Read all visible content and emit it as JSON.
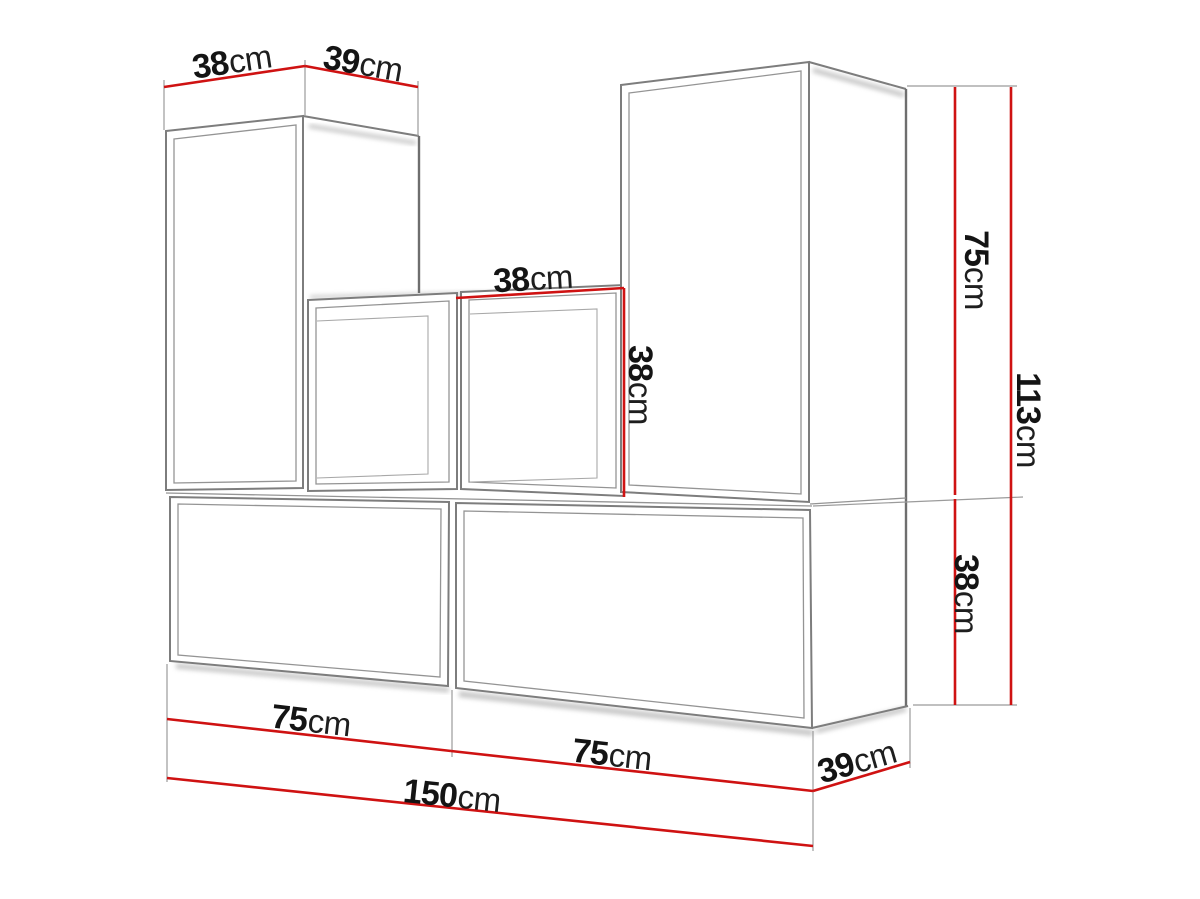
{
  "diagram": {
    "type": "furniture-dimension-diagram",
    "subject": "modular wall unit set of six cabinets in perspective view",
    "unit": "cm",
    "colors": {
      "dimension_line": "#cf1212",
      "outline": "#7d7d7d",
      "text": "#141414",
      "background": "#ffffff"
    },
    "dimensions": {
      "upper_left_width": {
        "value": "38",
        "unit": "cm"
      },
      "upper_left_depth": {
        "value": "39",
        "unit": "cm"
      },
      "cube_width": {
        "value": "38",
        "unit": "cm"
      },
      "cube_height": {
        "value": "38",
        "unit": "cm"
      },
      "upper_right_height": {
        "value": "75",
        "unit": "cm"
      },
      "total_height": {
        "value": "113",
        "unit": "cm"
      },
      "base_height": {
        "value": "38",
        "unit": "cm"
      },
      "base_left_width": {
        "value": "75",
        "unit": "cm"
      },
      "base_right_width": {
        "value": "75",
        "unit": "cm"
      },
      "base_depth": {
        "value": "39",
        "unit": "cm"
      },
      "base_total_width": {
        "value": "150",
        "unit": "cm"
      }
    }
  }
}
